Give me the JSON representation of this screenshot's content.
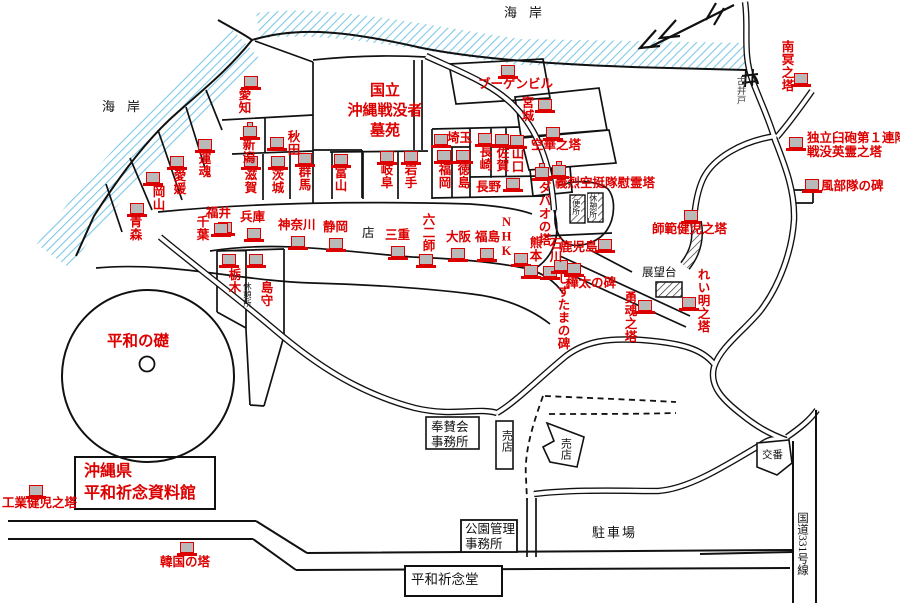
{
  "colors": {
    "red": "#dd0000",
    "black": "#111111",
    "sea_hatch": "#7fc9e6",
    "icon_fill": "#b9b9b9"
  },
  "cemetery": {
    "lines": [
      "国立",
      "沖縄戦没者",
      "墓苑"
    ]
  },
  "museum": {
    "lines": [
      "沖縄県",
      "平和祈念資料館"
    ]
  },
  "peace_foundation_label": "平和の礎",
  "monuments": [
    {
      "name": "aichi",
      "label": "愛知",
      "x": 236,
      "y": 88,
      "dir": "v",
      "icon": {
        "x": 244,
        "y": 76
      }
    },
    {
      "name": "niigata",
      "label": "新潟",
      "x": 240,
      "y": 138,
      "dir": "v",
      "icon": {
        "x": 243,
        "y": 126,
        "peak": true
      }
    },
    {
      "name": "akita",
      "label": "秋田",
      "x": 285,
      "y": 130,
      "dir": "v",
      "icon": {
        "x": 270,
        "y": 137
      }
    },
    {
      "name": "shiga",
      "label": "滋賀",
      "x": 242,
      "y": 168,
      "dir": "v",
      "icon": {
        "x": 244,
        "y": 156
      }
    },
    {
      "name": "ibaraki",
      "label": "茨城",
      "x": 269,
      "y": 168,
      "dir": "v",
      "icon": {
        "x": 271,
        "y": 156
      }
    },
    {
      "name": "gunma",
      "label": "群馬",
      "x": 296,
      "y": 165,
      "dir": "v",
      "icon": {
        "x": 298,
        "y": 153
      }
    },
    {
      "name": "toyama",
      "label": "富山",
      "x": 332,
      "y": 166,
      "dir": "v",
      "icon": {
        "x": 334,
        "y": 154
      }
    },
    {
      "name": "gifu",
      "label": "岐阜",
      "x": 378,
      "y": 163,
      "dir": "v",
      "icon": {
        "x": 380,
        "y": 151
      }
    },
    {
      "name": "iwate",
      "label": "岩手",
      "x": 402,
      "y": 163,
      "dir": "v",
      "icon": {
        "x": 404,
        "y": 151
      }
    },
    {
      "name": "unkon",
      "label": "運魂",
      "x": 196,
      "y": 152,
      "dir": "v",
      "icon": {
        "x": 198,
        "y": 139
      }
    },
    {
      "name": "ehime",
      "label": "愛媛",
      "x": 171,
      "y": 169,
      "dir": "v",
      "icon": {
        "x": 170,
        "y": 156
      }
    },
    {
      "name": "okayama",
      "label": "岡山",
      "x": 150,
      "y": 185,
      "dir": "v",
      "icon": {
        "x": 146,
        "y": 172
      }
    },
    {
      "name": "aomori",
      "label": "青森",
      "x": 127,
      "y": 215,
      "dir": "v",
      "icon": {
        "x": 130,
        "y": 203
      }
    },
    {
      "name": "chiba",
      "label": "千葉",
      "x": 194,
      "y": 215,
      "dir": "v",
      "icon": {
        "x": 218,
        "y": 222
      }
    },
    {
      "name": "fukui",
      "label": "福井",
      "x": 206,
      "y": 207,
      "dir": "h",
      "icon": {
        "x": 214,
        "y": 223
      }
    },
    {
      "name": "hyogo",
      "label": "兵庫",
      "x": 240,
      "y": 211,
      "dir": "h",
      "icon": {
        "x": 247,
        "y": 228
      }
    },
    {
      "name": "kanagawa",
      "label": "神奈川",
      "x": 278,
      "y": 219,
      "dir": "h",
      "icon": {
        "x": 291,
        "y": 236
      }
    },
    {
      "name": "shizuoka",
      "label": "静岡",
      "x": 323,
      "y": 221,
      "dir": "h",
      "icon": {
        "x": 329,
        "y": 238
      }
    },
    {
      "name": "mie",
      "label": "三重",
      "x": 385,
      "y": 229,
      "dir": "h",
      "icon": {
        "x": 391,
        "y": 246
      }
    },
    {
      "name": "rokuni-shi",
      "label": "六二師",
      "x": 420,
      "y": 213,
      "dir": "v",
      "icon": {
        "x": 419,
        "y": 254
      }
    },
    {
      "name": "osaka",
      "label": "大阪",
      "x": 446,
      "y": 231,
      "dir": "h",
      "icon": {
        "x": 451,
        "y": 248
      }
    },
    {
      "name": "fukushima",
      "label": "福島",
      "x": 475,
      "y": 231,
      "dir": "h",
      "icon": {
        "x": 480,
        "y": 248
      }
    },
    {
      "name": "nhk",
      "label": "NHK",
      "x": 499,
      "y": 215,
      "dir": "v",
      "icon": {
        "x": 514,
        "y": 253
      }
    },
    {
      "name": "kumamoto",
      "label": "熊本",
      "x": 527,
      "y": 236,
      "dir": "v",
      "icon": {
        "x": 524,
        "y": 265
      }
    },
    {
      "name": "ishikawa",
      "label": "石川",
      "x": 547,
      "y": 237,
      "dir": "v",
      "icon": {
        "x": 543,
        "y": 266
      }
    },
    {
      "name": "kagoshima",
      "label": "鹿児島",
      "x": 560,
      "y": 241,
      "dir": "h",
      "icon": {
        "x": 598,
        "y": 239
      }
    },
    {
      "name": "shizutama-no-hi",
      "label": "しずたまの碑",
      "x": 555,
      "y": 272,
      "dir": "v",
      "icon": {
        "x": 554,
        "y": 260
      }
    },
    {
      "name": "karafuto-no-hi",
      "label": "樺太の碑",
      "x": 566,
      "y": 277,
      "dir": "h",
      "icon": {
        "x": 567,
        "y": 263
      }
    },
    {
      "name": "yukon-no-to",
      "label": "勇魂之塔",
      "x": 622,
      "y": 291,
      "dir": "v",
      "icon": {
        "x": 638,
        "y": 300
      }
    },
    {
      "name": "reimei-no-to",
      "label": "れい明之塔",
      "x": 695,
      "y": 268,
      "dir": "v",
      "icon": {
        "x": 682,
        "y": 297
      }
    },
    {
      "name": "shihan-kenji-no-to",
      "label": "師範健児之塔",
      "x": 652,
      "y": 223,
      "dir": "h",
      "icon": {
        "x": 684,
        "y": 210
      }
    },
    {
      "name": "saitama",
      "label": "埼玉",
      "x": 447,
      "y": 132,
      "dir": "h",
      "icon": {
        "x": 434,
        "y": 134
      }
    },
    {
      "name": "nagasaki",
      "label": "長崎",
      "x": 477,
      "y": 145,
      "dir": "v",
      "icon": {
        "x": 478,
        "y": 133
      }
    },
    {
      "name": "saga",
      "label": "佐賀",
      "x": 494,
      "y": 146,
      "dir": "v",
      "icon": {
        "x": 495,
        "y": 134
      }
    },
    {
      "name": "yamaguchi",
      "label": "山口",
      "x": 509,
      "y": 147,
      "dir": "v",
      "icon": {
        "x": 510,
        "y": 135
      }
    },
    {
      "name": "fukuoka",
      "label": "福岡",
      "x": 436,
      "y": 163,
      "dir": "v",
      "icon": {
        "x": 437,
        "y": 150
      }
    },
    {
      "name": "tokushima",
      "label": "徳島",
      "x": 455,
      "y": 163,
      "dir": "v",
      "icon": {
        "x": 456,
        "y": 150
      }
    },
    {
      "name": "nagano",
      "label": "長野",
      "x": 476,
      "y": 181,
      "dir": "h",
      "icon": {
        "x": 506,
        "y": 178
      }
    },
    {
      "name": "miyagi",
      "label": "宮城",
      "x": 519,
      "y": 96,
      "dir": "v",
      "icon": {
        "x": 538,
        "y": 99
      }
    },
    {
      "name": "bougainville",
      "label": "ブーゲンビル",
      "x": 478,
      "y": 78,
      "dir": "h",
      "icon": {
        "x": 501,
        "y": 65
      }
    },
    {
      "name": "kuge-no-to",
      "label": "空華之塔",
      "x": 531,
      "y": 139,
      "dir": "h",
      "icon": {
        "x": 546,
        "y": 127
      }
    },
    {
      "name": "davao-no-to",
      "label": "ダバオの塔",
      "x": 536,
      "y": 181,
      "dir": "v",
      "icon": {
        "x": 535,
        "y": 167,
        "peak": true
      }
    },
    {
      "name": "giretsu-kuteitai-ireito",
      "label": "義烈空挺隊慰霊塔",
      "x": 555,
      "y": 177,
      "dir": "h",
      "icon": {
        "x": 552,
        "y": 165,
        "peak": true
      }
    },
    {
      "name": "nanmei-no-to",
      "label": "南冥之塔",
      "x": 779,
      "y": 40,
      "dir": "v",
      "icon": {
        "x": 794,
        "y": 73
      }
    },
    {
      "name": "dokuritsu-kyuho",
      "lines": [
        "独立臼砲第１連隊",
        "戦没英霊之塔"
      ],
      "label": "独立臼砲第１連隊\n戦没英霊之塔",
      "x": 807,
      "y": 132,
      "dir": "h",
      "icon": {
        "x": 789,
        "y": 137
      }
    },
    {
      "name": "kaze-butai-no-hi",
      "label": "風部隊の碑",
      "x": 821,
      "y": 180,
      "dir": "h",
      "icon": {
        "x": 805,
        "y": 179
      }
    },
    {
      "name": "tochigi",
      "label": "栃木",
      "x": 226,
      "y": 268,
      "dir": "v",
      "icon": {
        "x": 222,
        "y": 254
      }
    },
    {
      "name": "shimamori",
      "label": "島守",
      "x": 258,
      "y": 281,
      "dir": "v",
      "icon": {
        "x": 249,
        "y": 254
      }
    },
    {
      "name": "kogyo-kenji-no-to",
      "label": "工業健児之塔",
      "x": 2,
      "y": 497,
      "dir": "h",
      "icon": {
        "x": 29,
        "y": 485
      }
    },
    {
      "name": "kankoku-no-to",
      "label": "韓国の塔",
      "x": 160,
      "y": 556,
      "dir": "h",
      "icon": {
        "x": 180,
        "y": 542
      }
    }
  ],
  "facilities": [
    {
      "name": "coast-label-west",
      "label": "海岸",
      "x": 102,
      "y": 99,
      "dir": "h",
      "size": 13,
      "spacing": 12
    },
    {
      "name": "coast-label-north",
      "label": "海岸",
      "x": 504,
      "y": 5,
      "dir": "h",
      "size": 13,
      "spacing": 12
    },
    {
      "name": "old-well-label",
      "label": "古井戸",
      "x": 733,
      "y": 76,
      "dir": "v",
      "size": 9.5,
      "color": "#444444"
    },
    {
      "name": "shop-plot-label",
      "label": "店",
      "x": 362,
      "y": 226,
      "dir": "h",
      "size": 12.5
    },
    {
      "name": "rest-area-west",
      "label": "休憩所",
      "x": 242,
      "y": 282,
      "dir": "v",
      "size": 8.5
    },
    {
      "name": "toilet-label",
      "label": "便所",
      "x": 571,
      "y": 199,
      "dir": "v",
      "size": 8,
      "hatchbg": true
    },
    {
      "name": "rest-area-east",
      "label": "休憩所",
      "x": 588,
      "y": 194,
      "dir": "v",
      "size": 8,
      "hatchbg": true
    },
    {
      "name": "observation-deck-label",
      "label": "展望台",
      "x": 642,
      "y": 266,
      "dir": "h",
      "size": 11.5
    },
    {
      "name": "hosankai-office",
      "lines": [
        "奉賛会",
        "事務所"
      ],
      "label": "奉賛会\n事務所",
      "x": 431,
      "y": 420,
      "dir": "h",
      "size": 12.5
    },
    {
      "name": "shop-1",
      "label": "売店",
      "x": 499,
      "y": 430,
      "dir": "v",
      "size": 11
    },
    {
      "name": "shop-2",
      "label": "売店",
      "x": 558,
      "y": 438,
      "dir": "v",
      "size": 11
    },
    {
      "name": "park-admin-office",
      "lines": [
        "公園管理",
        "事務所"
      ],
      "label": "公園管理\n事務所",
      "x": 465,
      "y": 522,
      "dir": "h",
      "size": 12.5
    },
    {
      "name": "parking-label",
      "label": "駐車場",
      "x": 592,
      "y": 525,
      "dir": "h",
      "size": 13,
      "spacing": 2
    },
    {
      "name": "peace-memorial-hall",
      "label": "平和祈念堂",
      "x": 411,
      "y": 572,
      "dir": "h",
      "size": 13.5
    },
    {
      "name": "police-box",
      "label": "交番",
      "x": 762,
      "y": 450,
      "dir": "h",
      "size": 10.5
    },
    {
      "name": "route-331",
      "label": "国道331号線",
      "x": 795,
      "y": 512,
      "dir": "v",
      "size": 11.5,
      "mixed": true
    }
  ]
}
